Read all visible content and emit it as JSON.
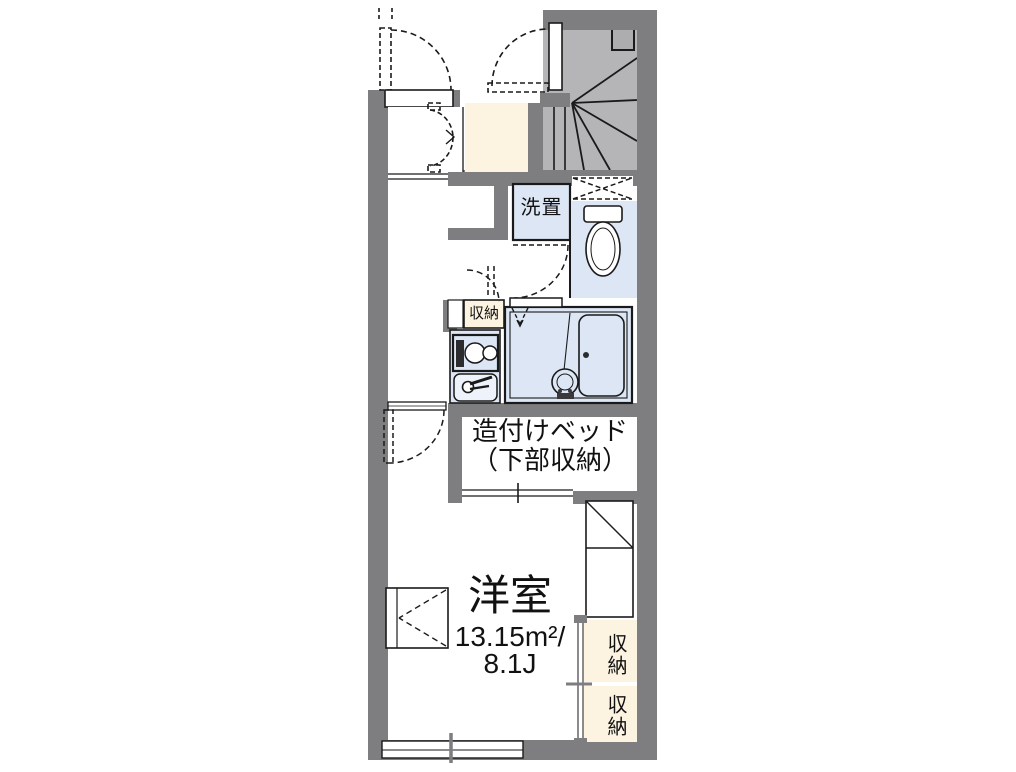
{
  "labels": {
    "laundry": "洗置",
    "kitchen_storage": "収納",
    "bed_line1": "造付けベッド",
    "bed_line2": "（下部収納）",
    "room_name": "洋室",
    "room_area_sqm": "13.15m²/",
    "room_area_tatami": "8.1J",
    "storage_upper": "収納",
    "storage_lower": "収納"
  },
  "colors": {
    "wall": "#7e7e81",
    "stair_fill": "#b5b5b7",
    "stair_box": "#adadaf",
    "water_area": "#dce6f4",
    "storage_fill": "#fcf3e1",
    "line": "#1a1a1a"
  }
}
